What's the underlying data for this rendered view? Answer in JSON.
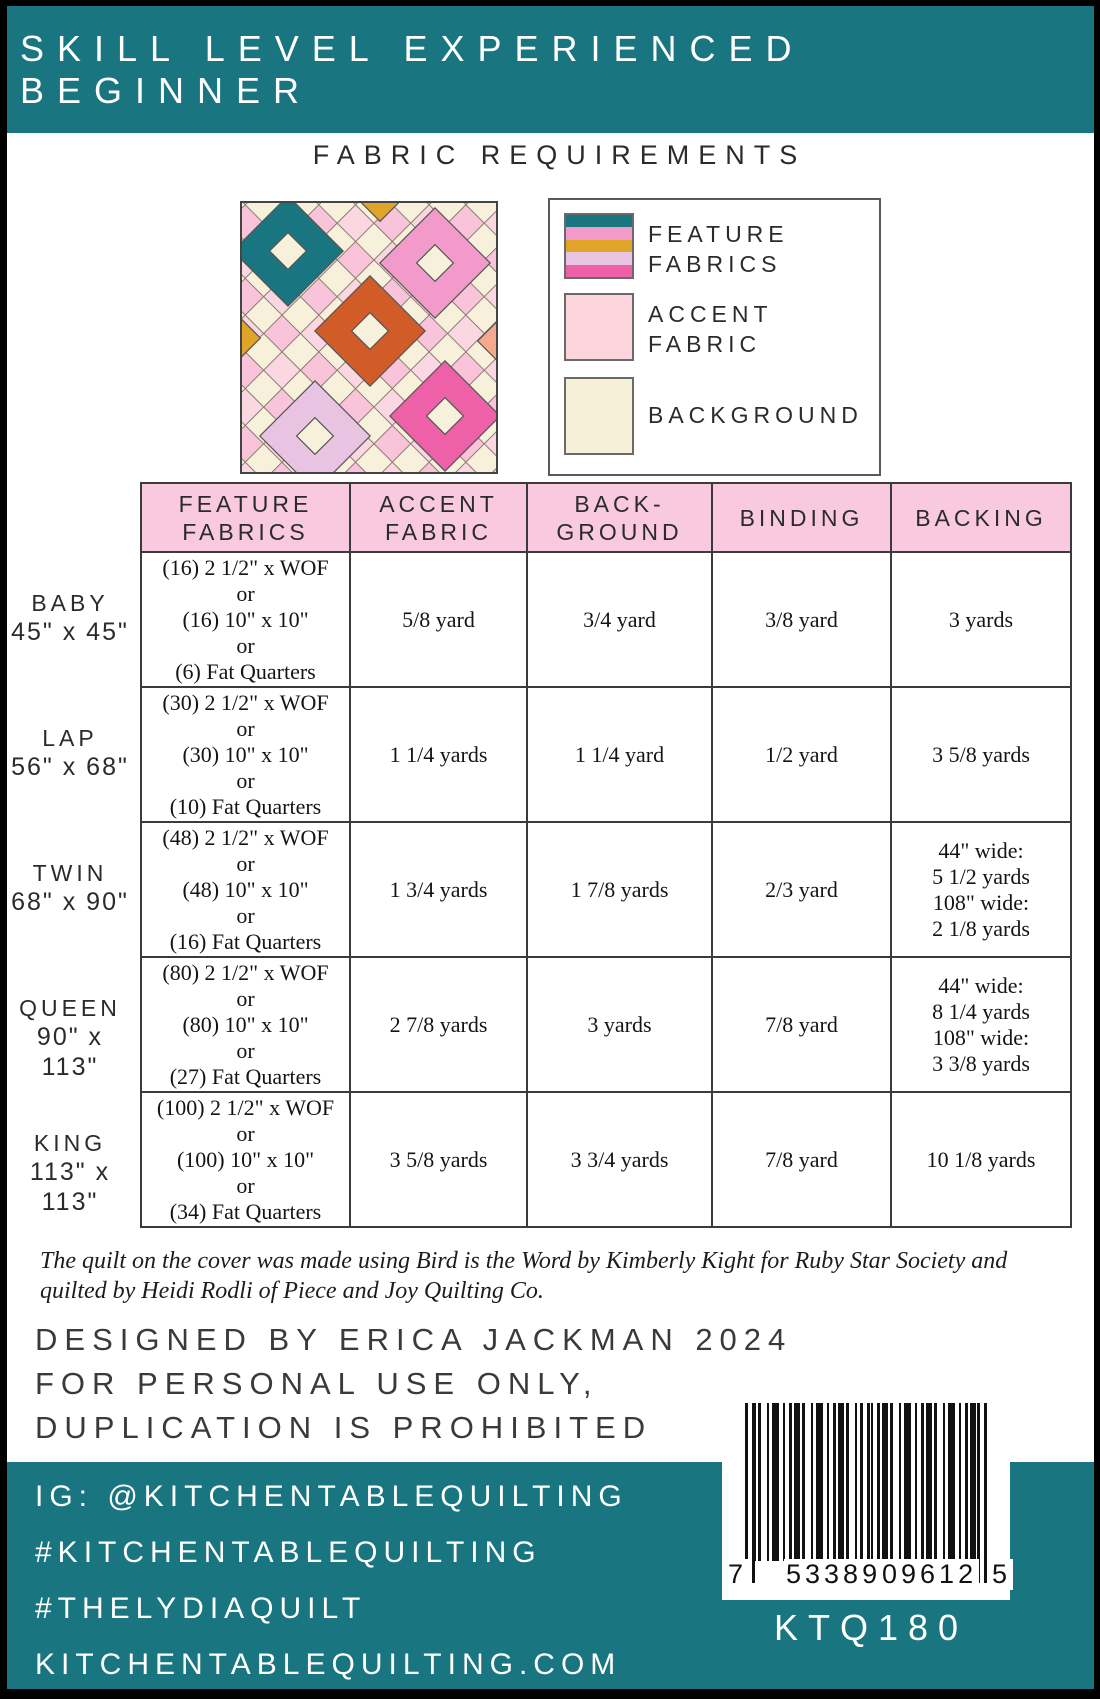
{
  "colors": {
    "teal": "#197680",
    "header_pink": "#F9CADF",
    "accent_pink": "#FBD4DC",
    "cream": "#F6F0D8",
    "gold": "#E0A429",
    "orange": "#D25C27",
    "medium_pink": "#F29BCB",
    "dark_pink": "#EE61A8",
    "lavender": "#E9C4E2"
  },
  "banner": {
    "text": "SKILL LEVEL EXPERIENCED BEGINNER"
  },
  "section_title": "FABRIC REQUIREMENTS",
  "legend": {
    "feature": {
      "line1": "FEATURE",
      "line2": "FABRICS"
    },
    "accent": {
      "line1": "ACCENT",
      "line2": "FABRIC"
    },
    "background": {
      "line1": "BACKGROUND"
    }
  },
  "table": {
    "headers": {
      "feature": [
        "FEATURE",
        "FABRICS"
      ],
      "accent": [
        "ACCENT",
        "FABRIC"
      ],
      "background": [
        "BACK-",
        "GROUND"
      ],
      "binding": [
        "BINDING"
      ],
      "backing": [
        "BACKING"
      ]
    },
    "rows": [
      {
        "size_name": "BABY",
        "size_dims": "45\" x 45\"",
        "feature": [
          "(16) 2 1/2\" x WOF",
          "or",
          "(16) 10\" x 10\"",
          "or",
          "(6) Fat Quarters"
        ],
        "accent": "5/8 yard",
        "background": "3/4 yard",
        "binding": "3/8 yard",
        "backing": [
          "3 yards"
        ]
      },
      {
        "size_name": "LAP",
        "size_dims": "56\" x 68\"",
        "feature": [
          "(30) 2 1/2\" x WOF",
          "or",
          "(30) 10\" x 10\"",
          "or",
          "(10) Fat Quarters"
        ],
        "accent": "1 1/4 yards",
        "background": "1 1/4 yard",
        "binding": "1/2 yard",
        "backing": [
          "3 5/8 yards"
        ]
      },
      {
        "size_name": "TWIN",
        "size_dims": "68\" x 90\"",
        "feature": [
          "(48) 2 1/2\" x WOF",
          "or",
          "(48) 10\" x 10\"",
          "or",
          "(16) Fat Quarters"
        ],
        "accent": "1 3/4 yards",
        "background": "1 7/8 yards",
        "binding": "2/3 yard",
        "backing": [
          "44\" wide:",
          "5 1/2 yards",
          "108\" wide:",
          "2 1/8 yards"
        ]
      },
      {
        "size_name": "QUEEN",
        "size_dims": "90\" x 113\"",
        "feature": [
          "(80) 2 1/2\" x WOF",
          "or",
          "(80) 10\" x 10\"",
          "or",
          "(27) Fat Quarters"
        ],
        "accent": "2 7/8 yards",
        "background": "3 yards",
        "binding": "7/8 yard",
        "backing": [
          "44\" wide:",
          "8 1/4 yards",
          "108\" wide:",
          "3 3/8 yards"
        ]
      },
      {
        "size_name": "KING",
        "size_dims": "113\" x 113\"",
        "feature": [
          "(100) 2 1/2\" x WOF",
          "or",
          "(100) 10\" x 10\"",
          "or",
          "(34) Fat Quarters"
        ],
        "accent": "3 5/8 yards",
        "background": "3 3/4 yards",
        "binding": "7/8 yard",
        "backing": [
          "10 1/8 yards"
        ]
      }
    ]
  },
  "note": "The quilt on the cover was made using Bird is the Word by Kimberly Kight for Ruby Star Society and quilted by Heidi Rodli of Piece and Joy Quilting Co.",
  "credits": {
    "line1": "DESIGNED BY ERICA JACKMAN 2024",
    "line2": "FOR PERSONAL USE ONLY,",
    "line3": "DUPLICATION IS PROHIBITED"
  },
  "footer": {
    "instagram": "IG: @KITCHENTABLEQUILTING",
    "hashtag1": "#KITCHENTABLEQUILTING",
    "hashtag2": "#THELYDIAQUILT",
    "website": "KITCHENTABLEQUILTING.COM",
    "product_code": "KTQ180"
  },
  "barcode": {
    "digit_left": "7",
    "digits_group1": "53389",
    "digits_group2": "09612",
    "digit_right": "5"
  }
}
